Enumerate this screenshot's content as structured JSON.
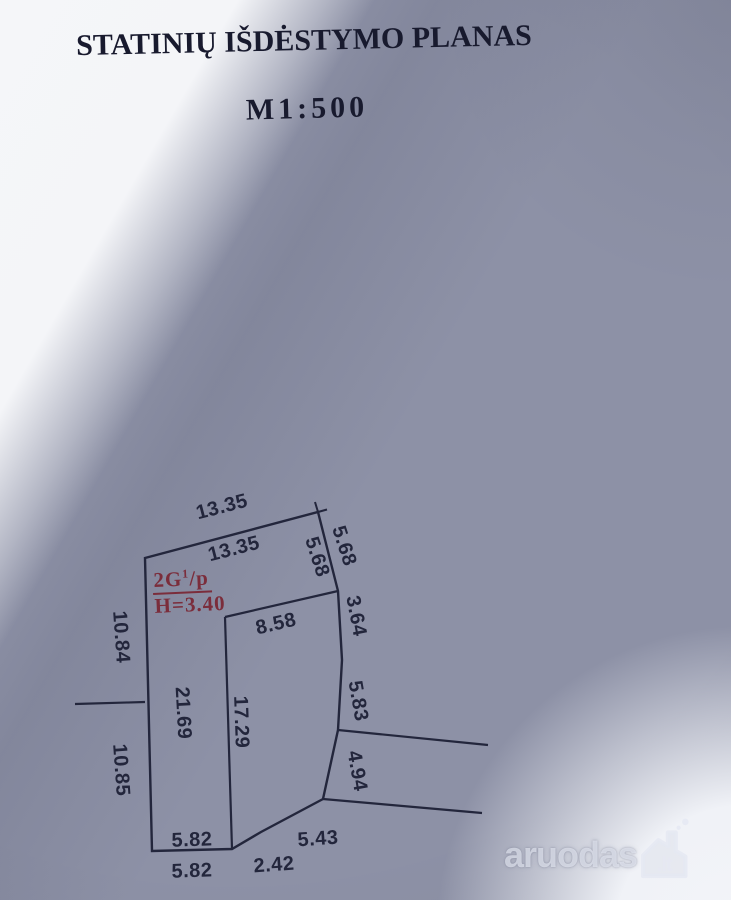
{
  "title": "STATINIŲ IŠDĖSTYMO PLANAS",
  "scale": "M1:500",
  "building": {
    "code_prefix": "2G",
    "code_sup": "1",
    "code_suffix": "/p",
    "height": "H=3.40"
  },
  "dimensions": {
    "top_outer": "13.35",
    "top_inner": "13.35",
    "northeast_outer": "5.68",
    "northeast_inner": "5.68",
    "east_upper": "3.64",
    "east_middle": "5.83",
    "east_lower": "4.94",
    "building_top": "8.58",
    "building_left": "17.29",
    "left_total": "21.69",
    "left_upper": "10.84",
    "left_lower": "10.85",
    "bottom_inner": "5.82",
    "bottom_outer": "5.82",
    "bottom_diagonal_short": "2.42",
    "bottom_diagonal_long": "5.43"
  },
  "watermark": {
    "name": "aruodas",
    "tld": ".lt"
  },
  "colors": {
    "ink": "#23263c",
    "red_label": "#7b2d3b",
    "paper_shadow": "#8d91a6",
    "paper_light": "#f5f6f9"
  }
}
